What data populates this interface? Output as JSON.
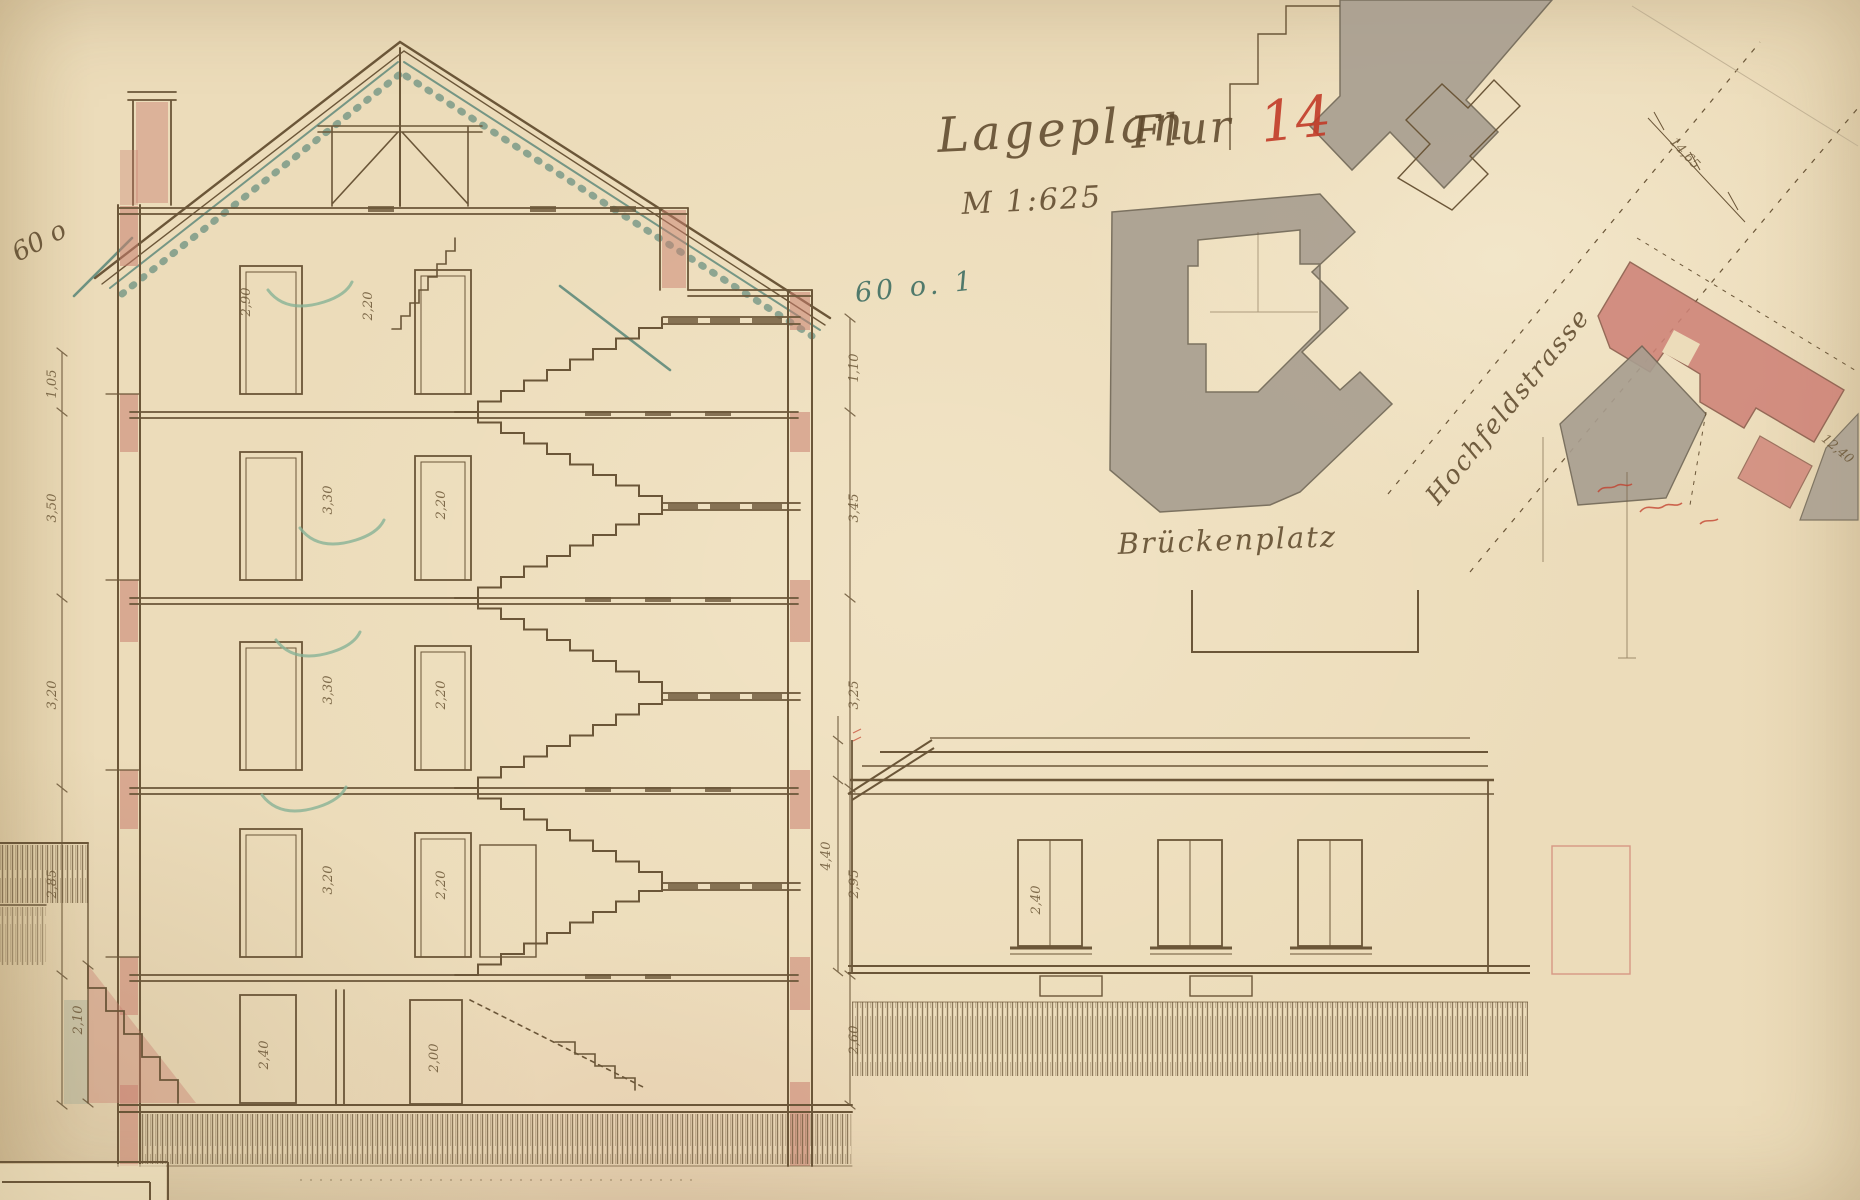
{
  "title": {
    "lageplan": "Lageplan",
    "flur": "Flur",
    "flur_number": "14",
    "scale": "M 1:625"
  },
  "labels": {
    "platz": "Brückenplatz",
    "street": "Hochfeldstrasse",
    "note_left": "60 o",
    "note_right": "60 o. 1"
  },
  "dims": {
    "left": [
      "1,05",
      "3,50",
      "3,20",
      "2,85",
      "2,10"
    ],
    "right": [
      "1,10",
      "3,45",
      "3,25",
      "2,95",
      "2,60"
    ],
    "rooms": [
      "2,90",
      "2,20",
      "3,30",
      "2,20",
      "3,30",
      "2,20",
      "3,20",
      "2,20",
      "2,40",
      "2,00"
    ],
    "outbuilding": [
      "2,40",
      "4,40"
    ],
    "plan": [
      "14,65",
      "12,40"
    ]
  },
  "colors": {
    "paper": "#ecdcba",
    "ink": "#6b5638",
    "red_wash": "#c97f70",
    "gray_wash": "#a89e90",
    "teal": "#4d7f73",
    "red_accent": "#c23b28",
    "green_check": "#86b296"
  }
}
